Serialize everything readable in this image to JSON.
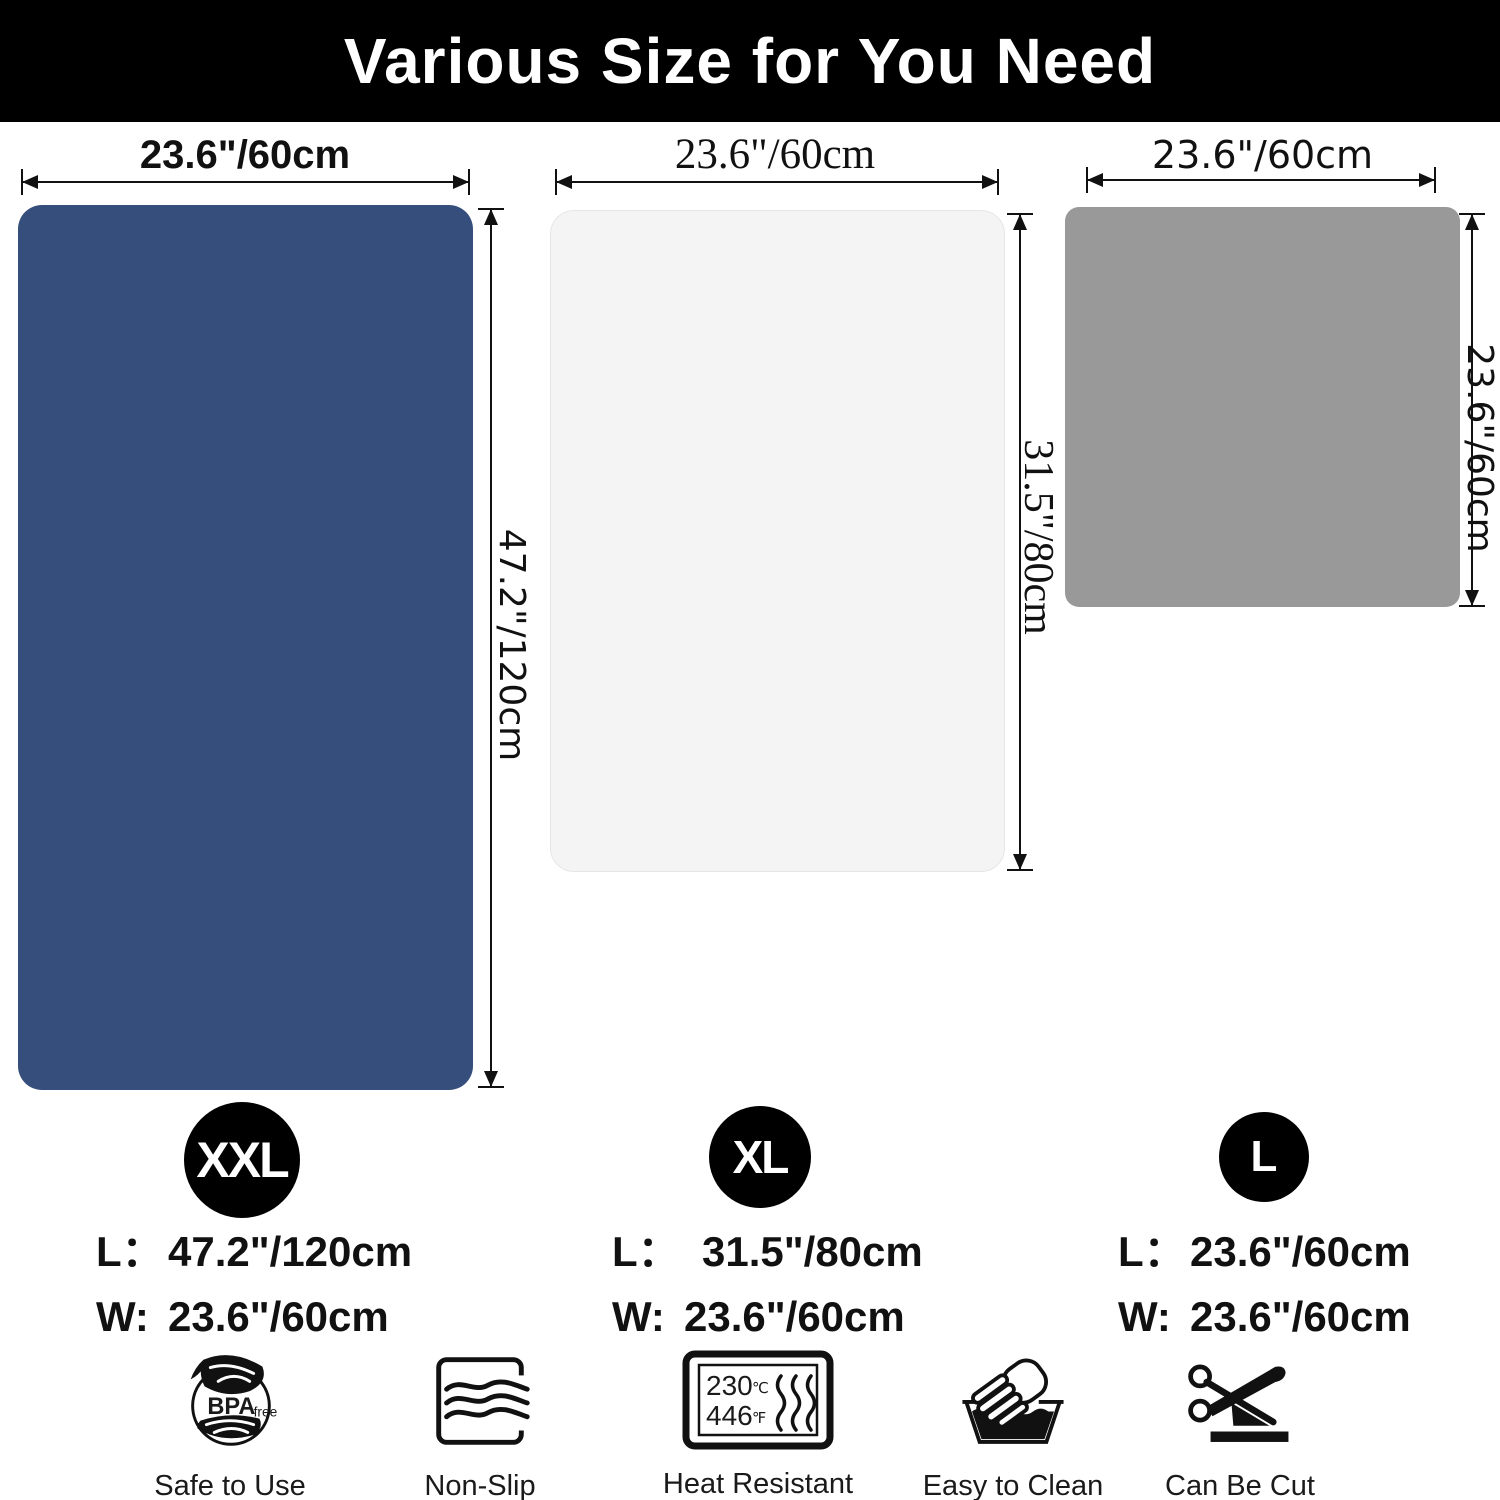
{
  "banner": {
    "title": "Various Size for You Need",
    "bg_color": "#000000",
    "text_color": "#ffffff"
  },
  "mats": [
    {
      "name": "XXL mat",
      "badge": "XXL",
      "color": "#364e7c",
      "top_label": "23.6\"/60cm",
      "side_label": "47.2\"/120cm",
      "length_prefix": "L：",
      "length_value": "47.2\"/120cm",
      "width_prefix": "W:",
      "width_value": "23.6\"/60cm"
    },
    {
      "name": "XL mat",
      "badge": "XL",
      "color": "#f4f4f4",
      "top_label": "23.6\"/60cm",
      "side_label": "31.5\"/80cm",
      "length_prefix": "L：",
      "length_value": "31.5\"/80cm",
      "width_prefix": "W:",
      "width_value": "23.6\"/60cm"
    },
    {
      "name": "L mat",
      "badge": "L",
      "color": "#999999",
      "top_label": "23.6\"/60cm",
      "side_label": "23.6\"/60cm",
      "length_prefix": "L：",
      "length_value": "23.6\"/60cm",
      "width_prefix": "W:",
      "width_value": "23.6\"/60cm"
    }
  ],
  "features": [
    {
      "icon": "bpa-free-icon",
      "label": "Safe to Use",
      "badge_text": "BPA",
      "badge_sub": "free"
    },
    {
      "icon": "non-slip-icon",
      "label": "Non-Slip"
    },
    {
      "icon": "heat-resistant-icon",
      "label": "Heat Resistant",
      "temp_c": "230",
      "unit_c": "℃",
      "temp_f": "446",
      "unit_f": "℉"
    },
    {
      "icon": "easy-to-clean-icon",
      "label": "Easy to Clean"
    },
    {
      "icon": "can-be-cut-icon",
      "label": "Can Be Cut"
    }
  ]
}
